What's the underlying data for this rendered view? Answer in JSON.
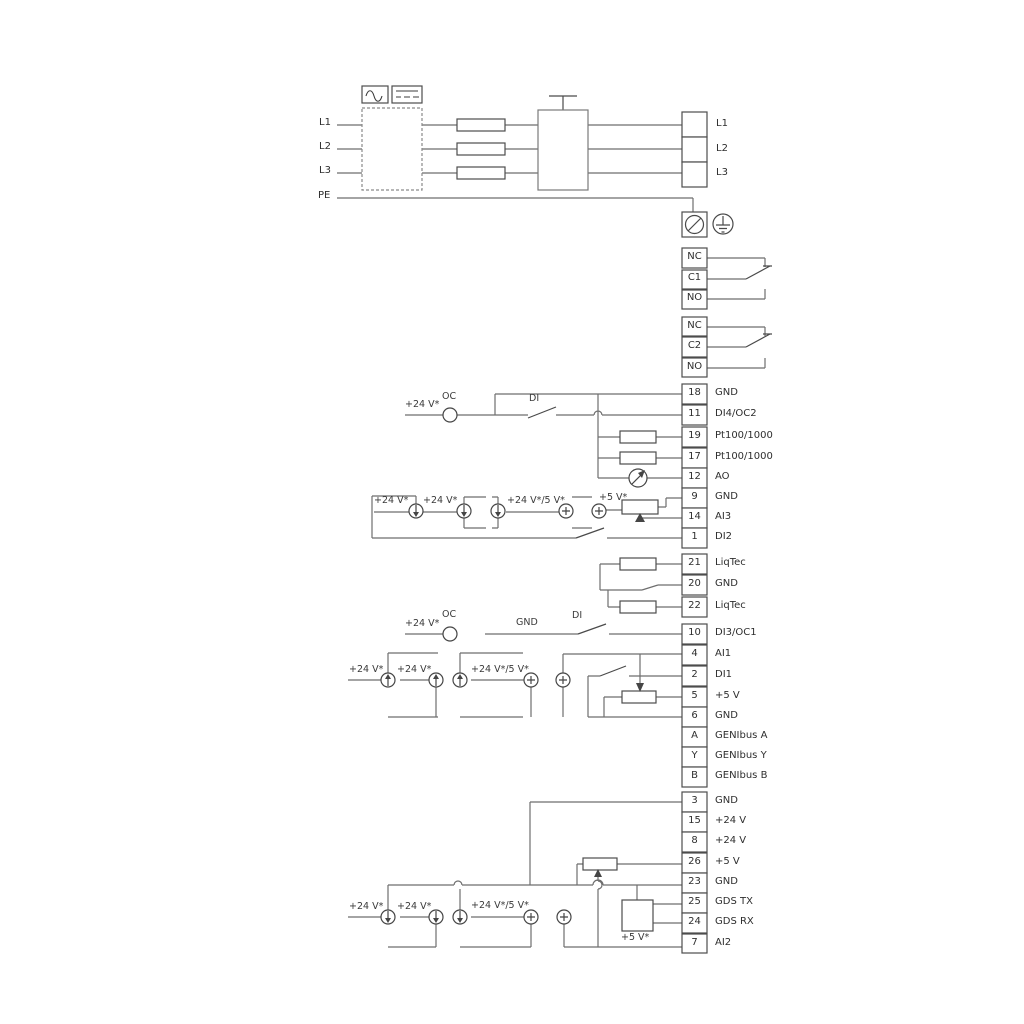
{
  "colors": {
    "wire": "#6e6e6e",
    "symbol": "#454545",
    "text": "#2e2e2e",
    "background": "#ffffff"
  },
  "labels": {
    "l1": "L1",
    "l2": "L2",
    "l3": "L3",
    "pe": "PE"
  },
  "relay1": {
    "nc": "NC",
    "c": "C1",
    "no": "NO"
  },
  "relay2": {
    "nc": "NC",
    "c": "C2",
    "no": "NO"
  },
  "io1": {
    "rows": [
      {
        "n": "18",
        "t": "GND"
      },
      {
        "n": "11",
        "t": "DI4/OC2"
      },
      {
        "n": "19",
        "t": "Pt100/1000"
      },
      {
        "n": "17",
        "t": "Pt100/1000"
      },
      {
        "n": "12",
        "t": "AO"
      },
      {
        "n": "9",
        "t": "GND"
      },
      {
        "n": "14",
        "t": "AI3"
      },
      {
        "n": "1",
        "t": "DI2"
      }
    ]
  },
  "liqtec": {
    "rows": [
      {
        "n": "21",
        "t": "LiqTec"
      },
      {
        "n": "20",
        "t": "GND"
      },
      {
        "n": "22",
        "t": "LiqTec"
      }
    ]
  },
  "io2": {
    "rows": [
      {
        "n": "10",
        "t": "DI3/OC1"
      },
      {
        "n": "4",
        "t": "AI1"
      },
      {
        "n": "2",
        "t": "DI1"
      },
      {
        "n": "5",
        "t": "+5 V"
      },
      {
        "n": "6",
        "t": "GND"
      },
      {
        "n": "A",
        "t": "GENIbus A"
      },
      {
        "n": "Y",
        "t": "GENIbus Y"
      },
      {
        "n": "B",
        "t": "GENIbus B"
      }
    ]
  },
  "io3": {
    "rows": [
      {
        "n": "3",
        "t": "GND"
      },
      {
        "n": "15",
        "t": "+24 V"
      },
      {
        "n": "8",
        "t": "+24 V"
      },
      {
        "n": "26",
        "t": "+5 V"
      },
      {
        "n": "23",
        "t": "GND"
      },
      {
        "n": "25",
        "t": "GDS TX"
      },
      {
        "n": "24",
        "t": "GDS RX"
      },
      {
        "n": "7",
        "t": "AI2"
      }
    ]
  },
  "ann": {
    "v24": "+24 V*",
    "v24_5": "+24 V*/5 V*",
    "v5": "+5 V*",
    "oc": "OC",
    "di": "DI",
    "gnd": "GND"
  }
}
